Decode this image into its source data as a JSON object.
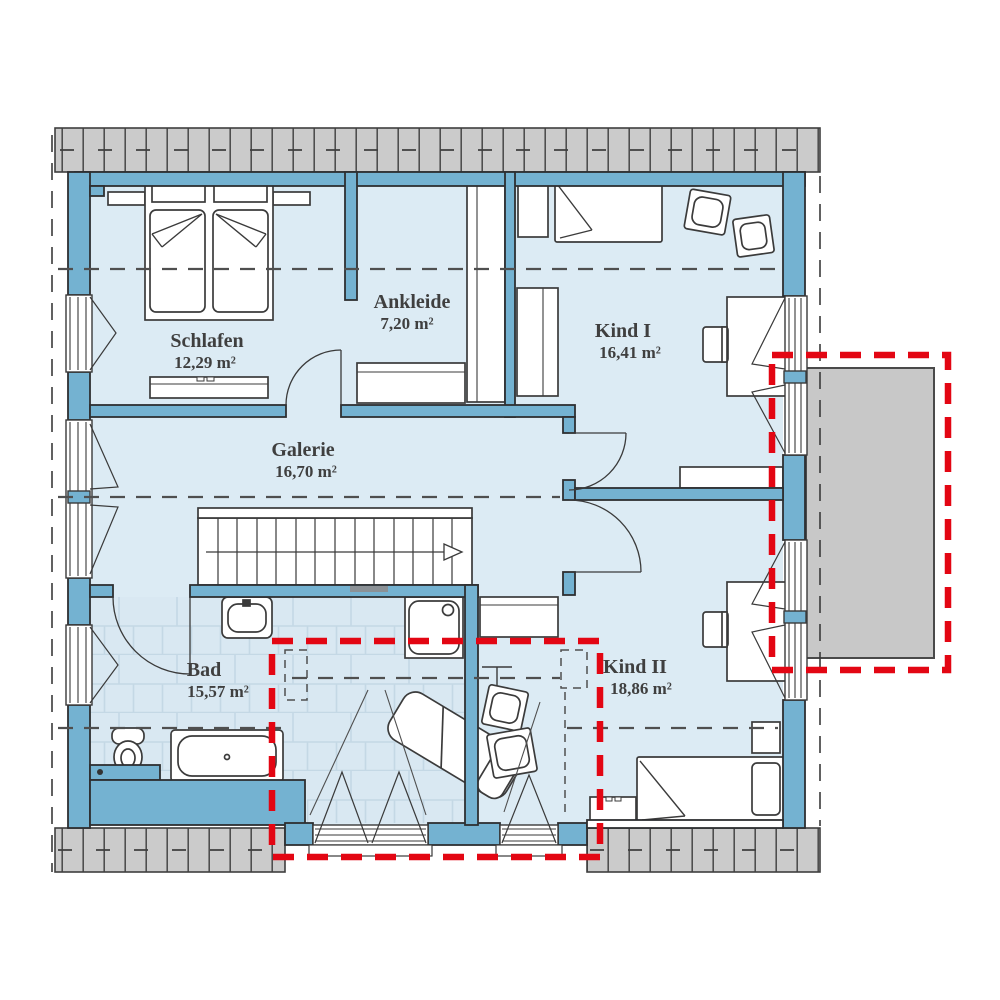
{
  "plan": {
    "title": "Dachgeschoss Grundriss",
    "rooms": [
      {
        "name": "Schlafen",
        "area": "12,29 m²"
      },
      {
        "name": "Ankleide",
        "area": "7,20 m²"
      },
      {
        "name": "Kind I",
        "area": "16,41 m²"
      },
      {
        "name": "Galerie",
        "area": "16,70 m²"
      },
      {
        "name": "Bad",
        "area": "15,57 m²"
      },
      {
        "name": "Kind II",
        "area": "18,86 m²"
      }
    ],
    "colors": {
      "wall": "#74b2d1",
      "room_fill": "#dcebf4",
      "tile_fill": "#d9e8f2",
      "tile_line": "#c4d8e5",
      "roof_hatch": "#cbcbcb",
      "balcony_fill": "#c8c8c8",
      "option_outline_red": "#e30613",
      "line_dark": "#3a3a3a"
    },
    "elements": [
      "double-bed-icon",
      "single-bed-icon",
      "wardrobe-icon",
      "dresser-icon",
      "desk-icon",
      "chair-icon",
      "cushion-icon",
      "stairs-icon",
      "stair-direction-arrow-icon",
      "bathtub-icon",
      "shower-icon",
      "toilet-icon",
      "sink-icon",
      "lounger-icon",
      "coat-rack-icon",
      "window-icon",
      "door-swing-icon",
      "roof-hatch-band",
      "balcony-option-area",
      "option-area-dashed-box",
      "roof-edge-dashed-line",
      "headroom-dashed-line",
      "dormer-windows"
    ]
  }
}
